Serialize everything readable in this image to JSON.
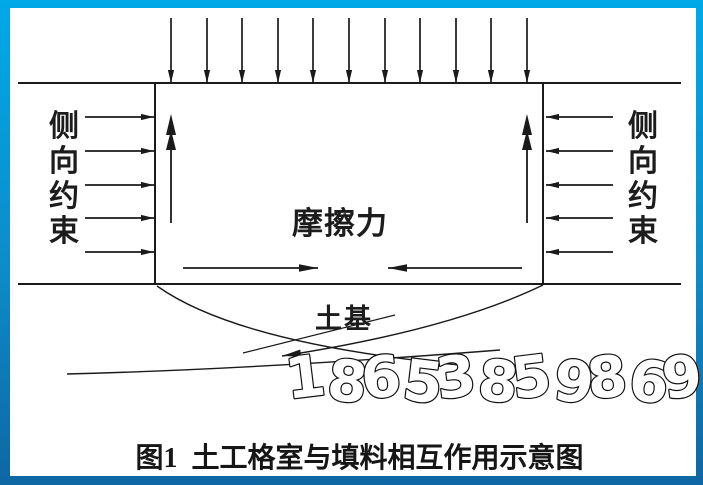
{
  "frame": {
    "gradient_top_color": "#00a9e8",
    "gradient_bottom_color": "#0e67a3",
    "background_color": "#ffffff",
    "line_color": "#1a1a1a"
  },
  "diagram": {
    "left_constraint_label": "侧向约束",
    "right_constraint_label": "侧向约束",
    "friction_label": "摩擦力",
    "soil_foundation_label": "土基",
    "top_load_arrow_count": 11,
    "side_confinement_arrow_count_per_side": 5,
    "uplift_arrow_count": 2,
    "friction_arrow_count": 2
  },
  "watermark": {
    "text": "18653859869",
    "fill_color": "#ffffff",
    "outline_color": "#111111"
  },
  "caption": {
    "text": "图1  土工格室与填料相互作用示意图"
  }
}
